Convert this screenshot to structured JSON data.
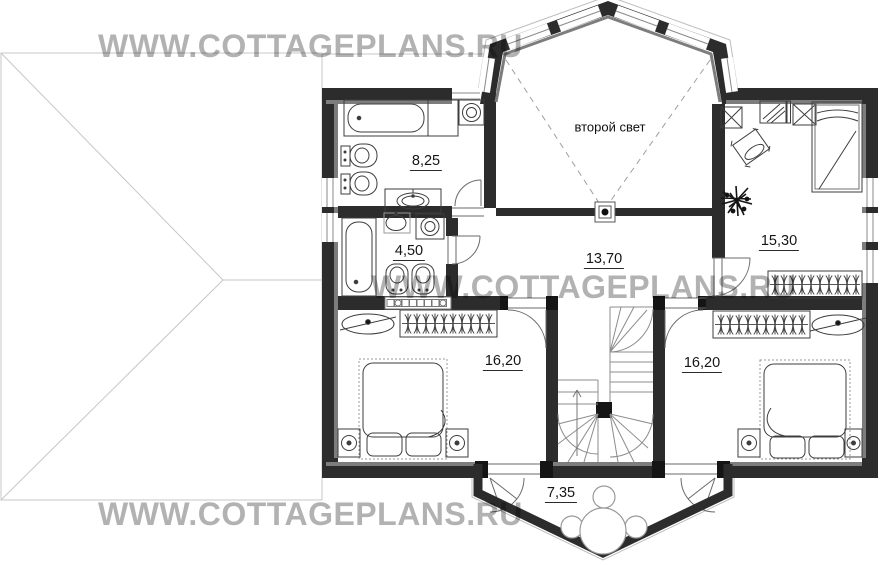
{
  "watermarks": [
    "WWW.COTTAGEPLANS.RU",
    "WWW.COTTAGEPLANS.RU",
    "WWW.COTTAGEPLANS.RU"
  ],
  "annotations": {
    "second_light": "второй свет"
  },
  "rooms": [
    {
      "name": "bathroom",
      "area": "8,25"
    },
    {
      "name": "shower-room",
      "area": "4,50"
    },
    {
      "name": "hall",
      "area": "13,70"
    },
    {
      "name": "bedroom-upper-right",
      "area": "15,30"
    },
    {
      "name": "bedroom-lower-left",
      "area": "16,20"
    },
    {
      "name": "bedroom-lower-right",
      "area": "16,20"
    },
    {
      "name": "balcony",
      "area": "7,35"
    }
  ],
  "colors": {
    "wall": "#2c2c2c",
    "wall_inner_band": "#7d7d7d",
    "furniture_line": "#3d3d3d",
    "roof_line": "#c7c7c7",
    "void_dash": "#9f9f9f",
    "watermark": "#b2b2b2"
  }
}
